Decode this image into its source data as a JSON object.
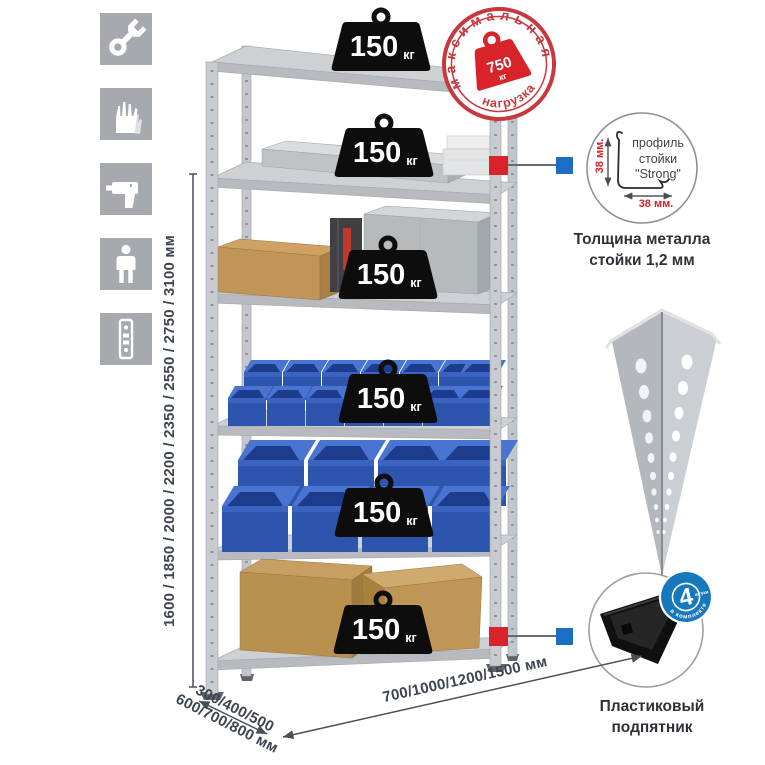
{
  "left_icons": [
    {
      "name": "wrench"
    },
    {
      "name": "gloves"
    },
    {
      "name": "drill"
    },
    {
      "name": "one-person-assembly"
    },
    {
      "name": "post-profile"
    }
  ],
  "dimensions": {
    "height": "1600 / 1850 / 2000 / 2200 / 2350 / 2550 / 2750 / 3100 мм",
    "depth_line1": "300/400/500",
    "depth_line2": "600/700/800 мм",
    "width": "700/1000/1200/1500 мм"
  },
  "max_load_stamp": {
    "arc_top": "максимальная",
    "arc_bottom": "нагрузка",
    "value": "750",
    "unit": "кг"
  },
  "shelves": [
    {
      "load": "150",
      "unit": "кг"
    },
    {
      "load": "150",
      "unit": "кг"
    },
    {
      "load": "150",
      "unit": "кг"
    },
    {
      "load": "150",
      "unit": "кг"
    },
    {
      "load": "150",
      "unit": "кг"
    },
    {
      "load": "150",
      "unit": "кг"
    }
  ],
  "profile_callout": {
    "line1": "профиль",
    "line2": "стойки",
    "line3": "\"Strong\"",
    "dim_vertical": "38 мм.",
    "dim_horizontal": "38 мм.",
    "caption_line1": "Толщина металла",
    "caption_line2": "стойки 1,2 мм"
  },
  "foot_callout": {
    "badge_value": "4",
    "badge_small": "штуки",
    "badge_arc": "в комплекте",
    "caption_line1": "Пластиковый",
    "caption_line2": "подпятник"
  },
  "colors": {
    "accent_red": "#d8232a",
    "marker_blue": "#1b6ec2",
    "bin_blue": "#2e55ae",
    "metal_gray": "#c6cacd",
    "icon_bg": "#a6a9ae",
    "dim_text": "#3d4550"
  }
}
